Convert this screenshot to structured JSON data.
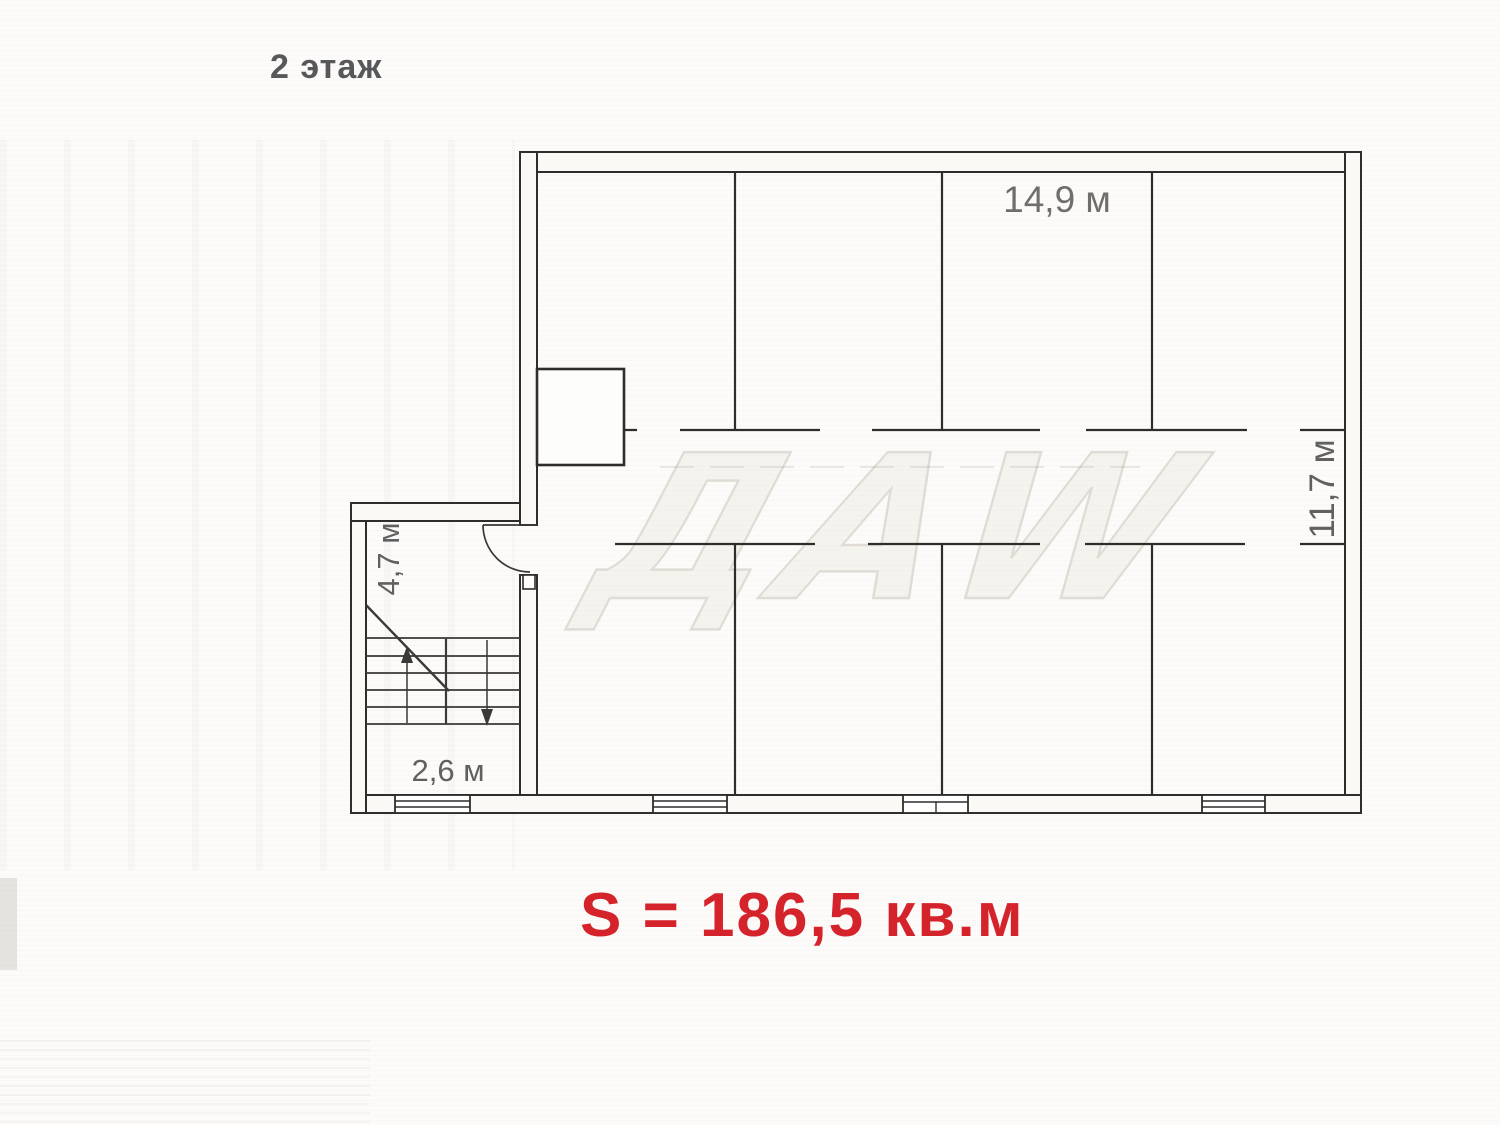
{
  "page": {
    "floor_label": "2 этаж",
    "total_area": "S = 186,5 кв.м",
    "watermark": "ДАW"
  },
  "plan": {
    "dimensions": {
      "top_room_width": "14,9 м",
      "right_depth": "11,7 м",
      "stairwell_width": "4,7 м",
      "landing_width": "2,6 м"
    }
  },
  "colors": {
    "area_text": "#d5232c",
    "floor_label_text": "#58585a",
    "dimension_text": "#606060",
    "plan_line": "#2e2d2b"
  }
}
